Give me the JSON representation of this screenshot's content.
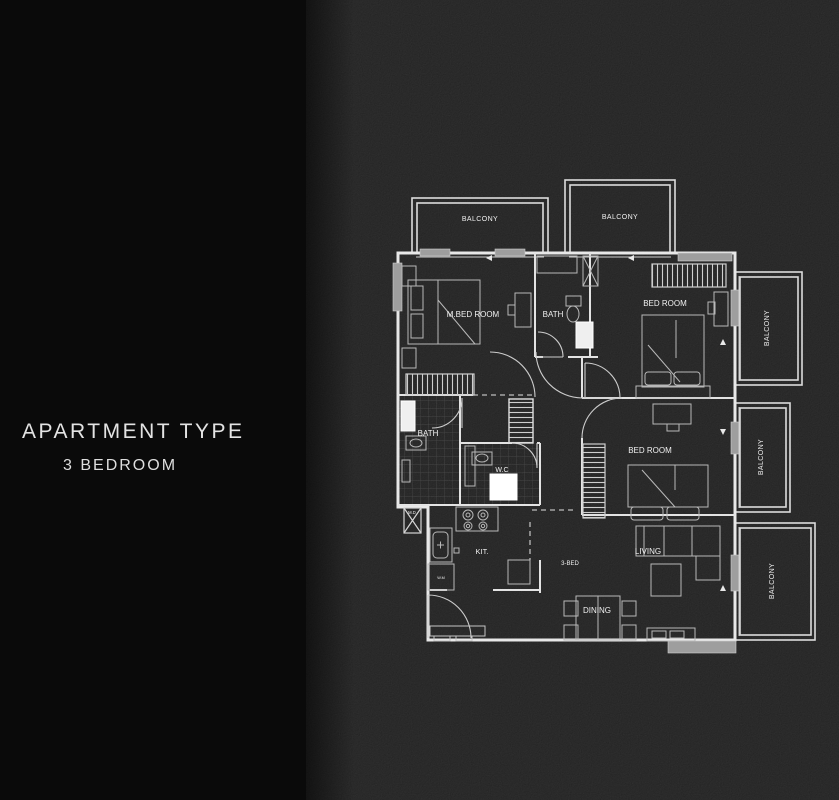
{
  "panel": {
    "title": "APARTMENT TYPE",
    "subtitle": "3 BEDROOM"
  },
  "plan": {
    "balconies": {
      "top_left": "BALCONY",
      "top_right": "BALCONY",
      "right_top": "BALCONY",
      "right_middle": "BALCONY",
      "right_bottom": "BALCONY"
    },
    "rooms": {
      "master_bedroom": "M.BED ROOM",
      "master_bath": "BATH",
      "bedroom_top_right": "BED ROOM",
      "bedroom_middle_right": "BED ROOM",
      "bath": "BATH",
      "wc": "W.C",
      "kitchen": "KIT.",
      "living": "LIVING",
      "dining": "DINING"
    },
    "annotations": {
      "unit_type": "3-BED",
      "washing_machine": "W.M",
      "meter_duct": "M.D"
    },
    "colors": {
      "background": "#1c1c1c",
      "panel": "#0a0a0a",
      "line": "#e8e8e8",
      "sill": "#9e9e9e",
      "text": "#f2f2f2"
    }
  }
}
